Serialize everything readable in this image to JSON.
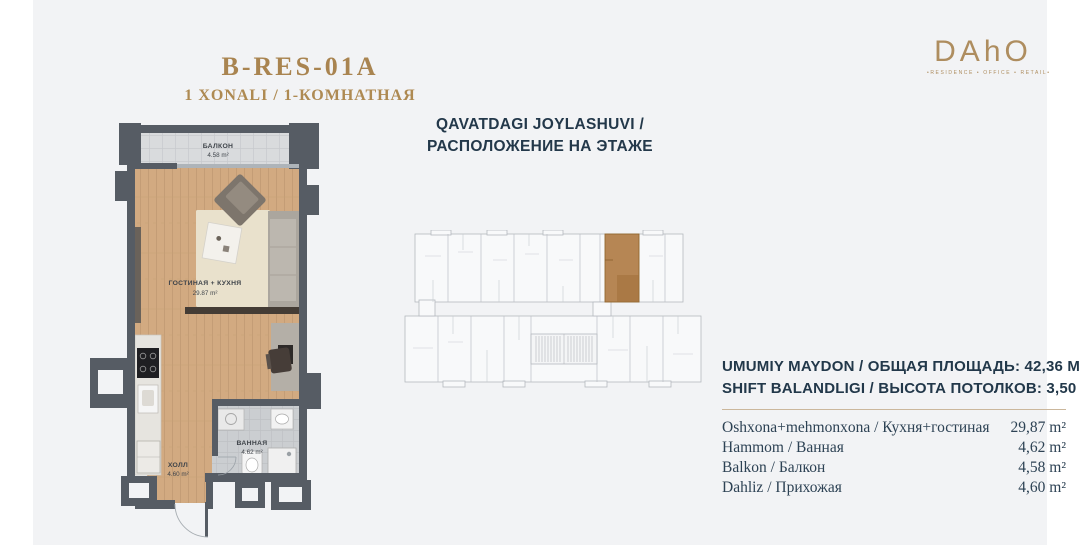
{
  "header": {
    "title": "B-RES-01A",
    "subtitle": "1 XONALI / 1-КОМНАТНАЯ"
  },
  "logo": {
    "text": "DAhO",
    "tagline": "•RESIDENCE • OFFICE • RETAIL•"
  },
  "location": {
    "line1": "QAVATDAGI JOYLASHUVI /",
    "line2": "РАСПОЛОЖЕНИЕ НА ЭТАЖЕ"
  },
  "plan": {
    "rooms": {
      "balcony": {
        "name": "БАЛКОН",
        "area": "4.58 m²"
      },
      "living": {
        "name": "ГОСТИНАЯ + КУХНЯ",
        "area": "29.87 m²"
      },
      "bath": {
        "name": "ВАННАЯ",
        "area": "4.62 m²"
      },
      "hall": {
        "name": "ХОЛЛ",
        "area": "4.60 m²"
      }
    }
  },
  "info": {
    "line1": "UMUMIY MAYDON / ОБЩАЯ ПЛОЩАДЬ: 42,36 М²",
    "line2": "SHIFT BALANDLIGI / ВЫСОТА ПОТОЛКОВ: 3,50 М",
    "rows": [
      {
        "label": "Oshxona+mehmonxona / Кухня+гостиная",
        "value": "29,87 m²"
      },
      {
        "label": "Hammom / Ванная",
        "value": "4,62 m²"
      },
      {
        "label": "Balkon / Балкон",
        "value": "4,58 m²"
      },
      {
        "label": "Dahliz / Прихожая",
        "value": "4,60 m²"
      }
    ]
  },
  "colors": {
    "accent_gold": "#a98450",
    "navy_text": "#23384a",
    "wall": "#565c64",
    "wood_floor": "#d2aa81",
    "highlight_unit": "#b07c45",
    "panel_bg": "#f2f3f5"
  }
}
